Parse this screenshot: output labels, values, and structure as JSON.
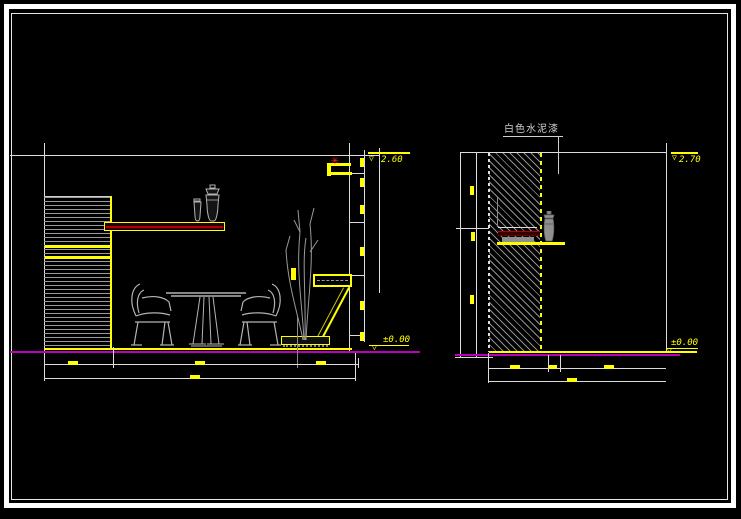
{
  "drawing": {
    "left_view": {
      "top_level_label": "2.60",
      "floor_level_label": "±0.00"
    },
    "right_view": {
      "finish_label": "白色水泥漆",
      "top_level_label": "2.70",
      "floor_level_label": "±0.00"
    },
    "icons": {
      "elevation_marker": "▽",
      "plant_star": "✳"
    },
    "colors": {
      "background": "#000000",
      "line_white": "#dcdcdc",
      "accent_yellow": "#ffff00",
      "floor_magenta": "#bb00bb",
      "shelf_red": "#a00000",
      "furniture_gray": "#b3b3b3",
      "hatch_gray": "#8f8f8f",
      "note_gray": "#cfcfcf",
      "star_red": "#ff2020"
    }
  }
}
